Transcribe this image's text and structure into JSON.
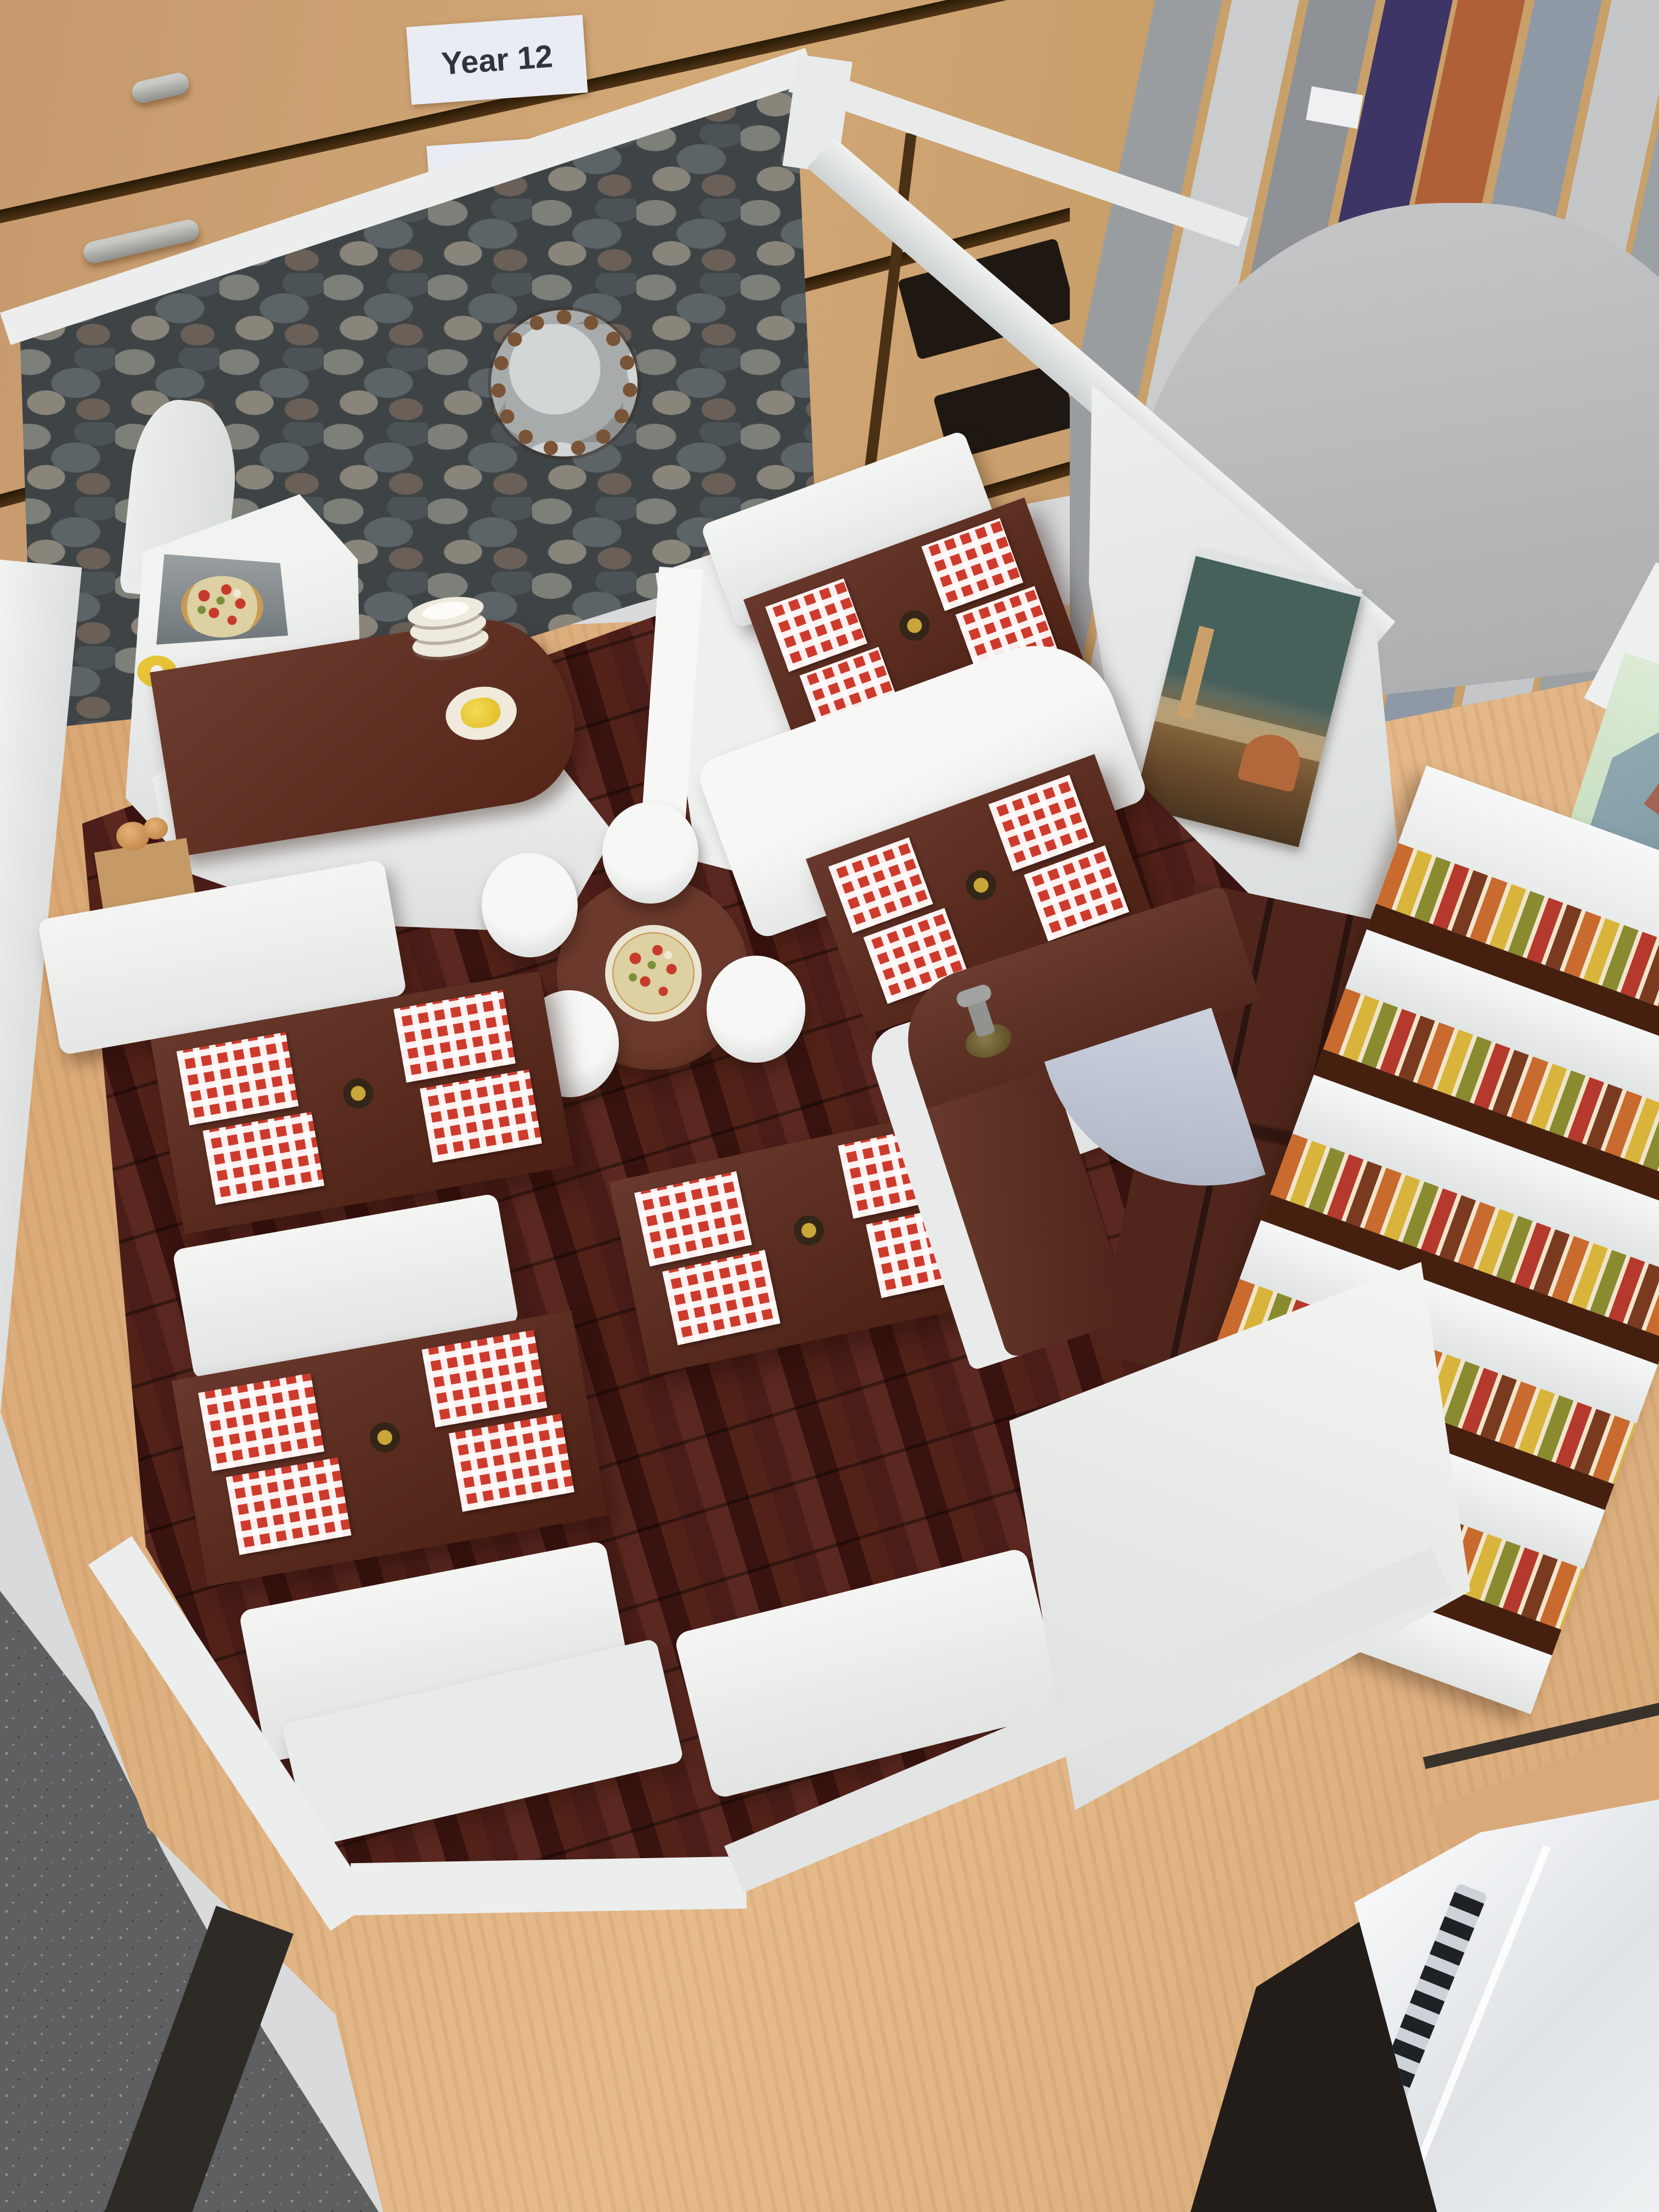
{
  "scene": {
    "type": "photograph",
    "description": "Miniature architectural model of an Italian pizzeria restaurant interior, built from foam board and card, displayed on a beech desk in a school design classroom",
    "setting": "Design & technology classroom with plan chest drawers, portfolio rack, office chair and grey carpet"
  },
  "background": {
    "plan_chest": {
      "material": "beech wood drawers with silver bar handles",
      "wood_color": "#c89a6b",
      "labels": [
        {
          "text": "Year 12"
        },
        {
          "text": "Year 11"
        }
      ]
    },
    "portfolio_rack": {
      "description": "vertical storage slots holding large portfolios and mount boards",
      "board_colors": [
        "#9a9da0",
        "#caccce",
        "#3d3566",
        "#b06038",
        "#8e99a5"
      ]
    },
    "office_chair": {
      "color": "#b7b9bb"
    },
    "carpet_color": "#5d5f61",
    "desk_color": "#dcab7c",
    "papers_on_desk": "white sheet and green architectural rendering of a building",
    "ring_binder": {
      "description": "white ring binder with clear plastic sleeves",
      "color": "#eef0f2"
    }
  },
  "model": {
    "floor": {
      "material": "dark red-brown wood plank print",
      "color": "#4a1d18"
    },
    "stone_wall": {
      "texture": "grey cobblestone print wallpaper",
      "color": "#3e4346"
    },
    "wall_mirror": {
      "description": "round silver mirror with ornate bronze petal frame"
    },
    "pizza_oven": {
      "description": "white plaster wood-fired pizza oven with chimney, pizza inside the arched mouth"
    },
    "serving_counter": {
      "top_color": "#5e342a",
      "items": [
        "stack of white plates",
        "plate of yellow pasta",
        "bread loaves on wooden block",
        "yellow flower dish"
      ]
    },
    "booth_tables": {
      "count": 5,
      "table_color": "#5b2d22",
      "placemats_per_table": 4,
      "placemat_pattern": "red and white gingham check",
      "placemat_color": "#cd3b2d",
      "centerpiece": "dark metal flower with gold bead"
    },
    "benches": {
      "color": "#f2f3f1",
      "material": "white painted foam board"
    },
    "round_table": {
      "color": "#5b2d22",
      "item": "pizza on cream board",
      "stools": 4,
      "stool_color": "#eceeec"
    },
    "bar_counter": {
      "shape": "curved L-shape",
      "top_color": "#5e342a",
      "fitting": "brass beer tap"
    },
    "back_cabinets": {
      "color": "#50261c"
    },
    "wine_shelves": {
      "rows": 5,
      "shelf_color": "#f2f3f1",
      "edge_color": "#46200f",
      "bottle_colors": [
        "#c96a2e",
        "#d9b43a",
        "#8a8a30",
        "#b5392c",
        "#7a3a20"
      ]
    },
    "wall_painting": {
      "subject": "Florence cityscape with cathedral dome",
      "sky_color": "#46605c"
    }
  }
}
